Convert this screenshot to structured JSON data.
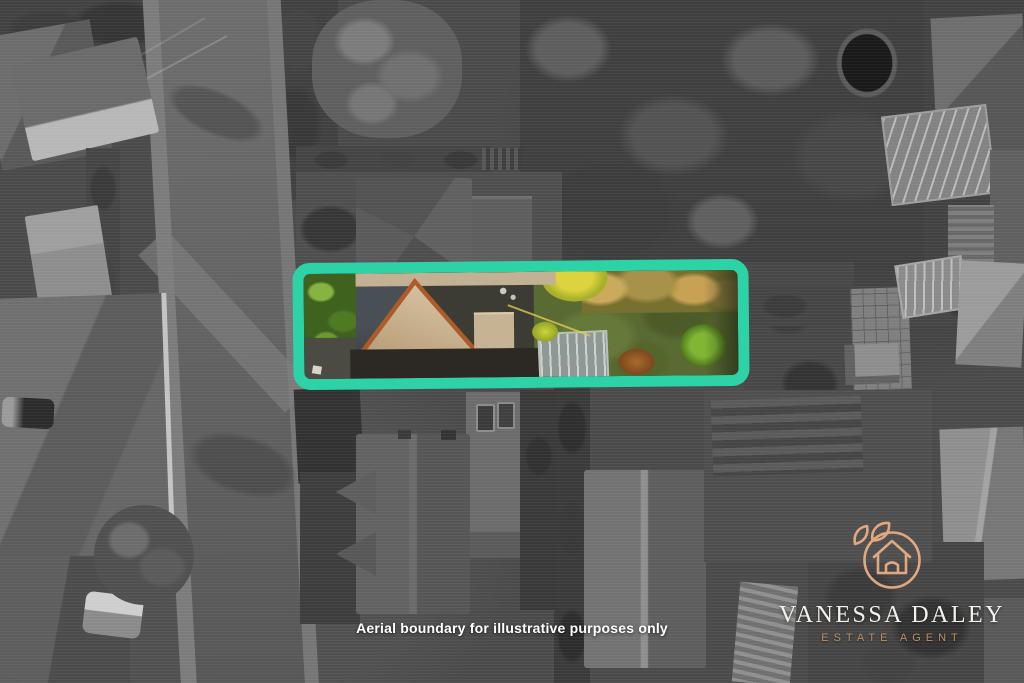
{
  "caption": {
    "text": "Aerial boundary for illustrative purposes only"
  },
  "logo": {
    "brand": "VANESSA DALEY",
    "tagline": "ESTATE AGENT",
    "brand_color": "#f4f1ec",
    "tagline_color": "#bd8f63",
    "icon_color": "#e0a87e",
    "icons": [
      "house-in-circle-icon",
      "leaf-icon",
      "small-leaf-icon"
    ]
  },
  "boundary": {
    "color": "#2dd3a6",
    "meaning": "highlighted property plot"
  }
}
